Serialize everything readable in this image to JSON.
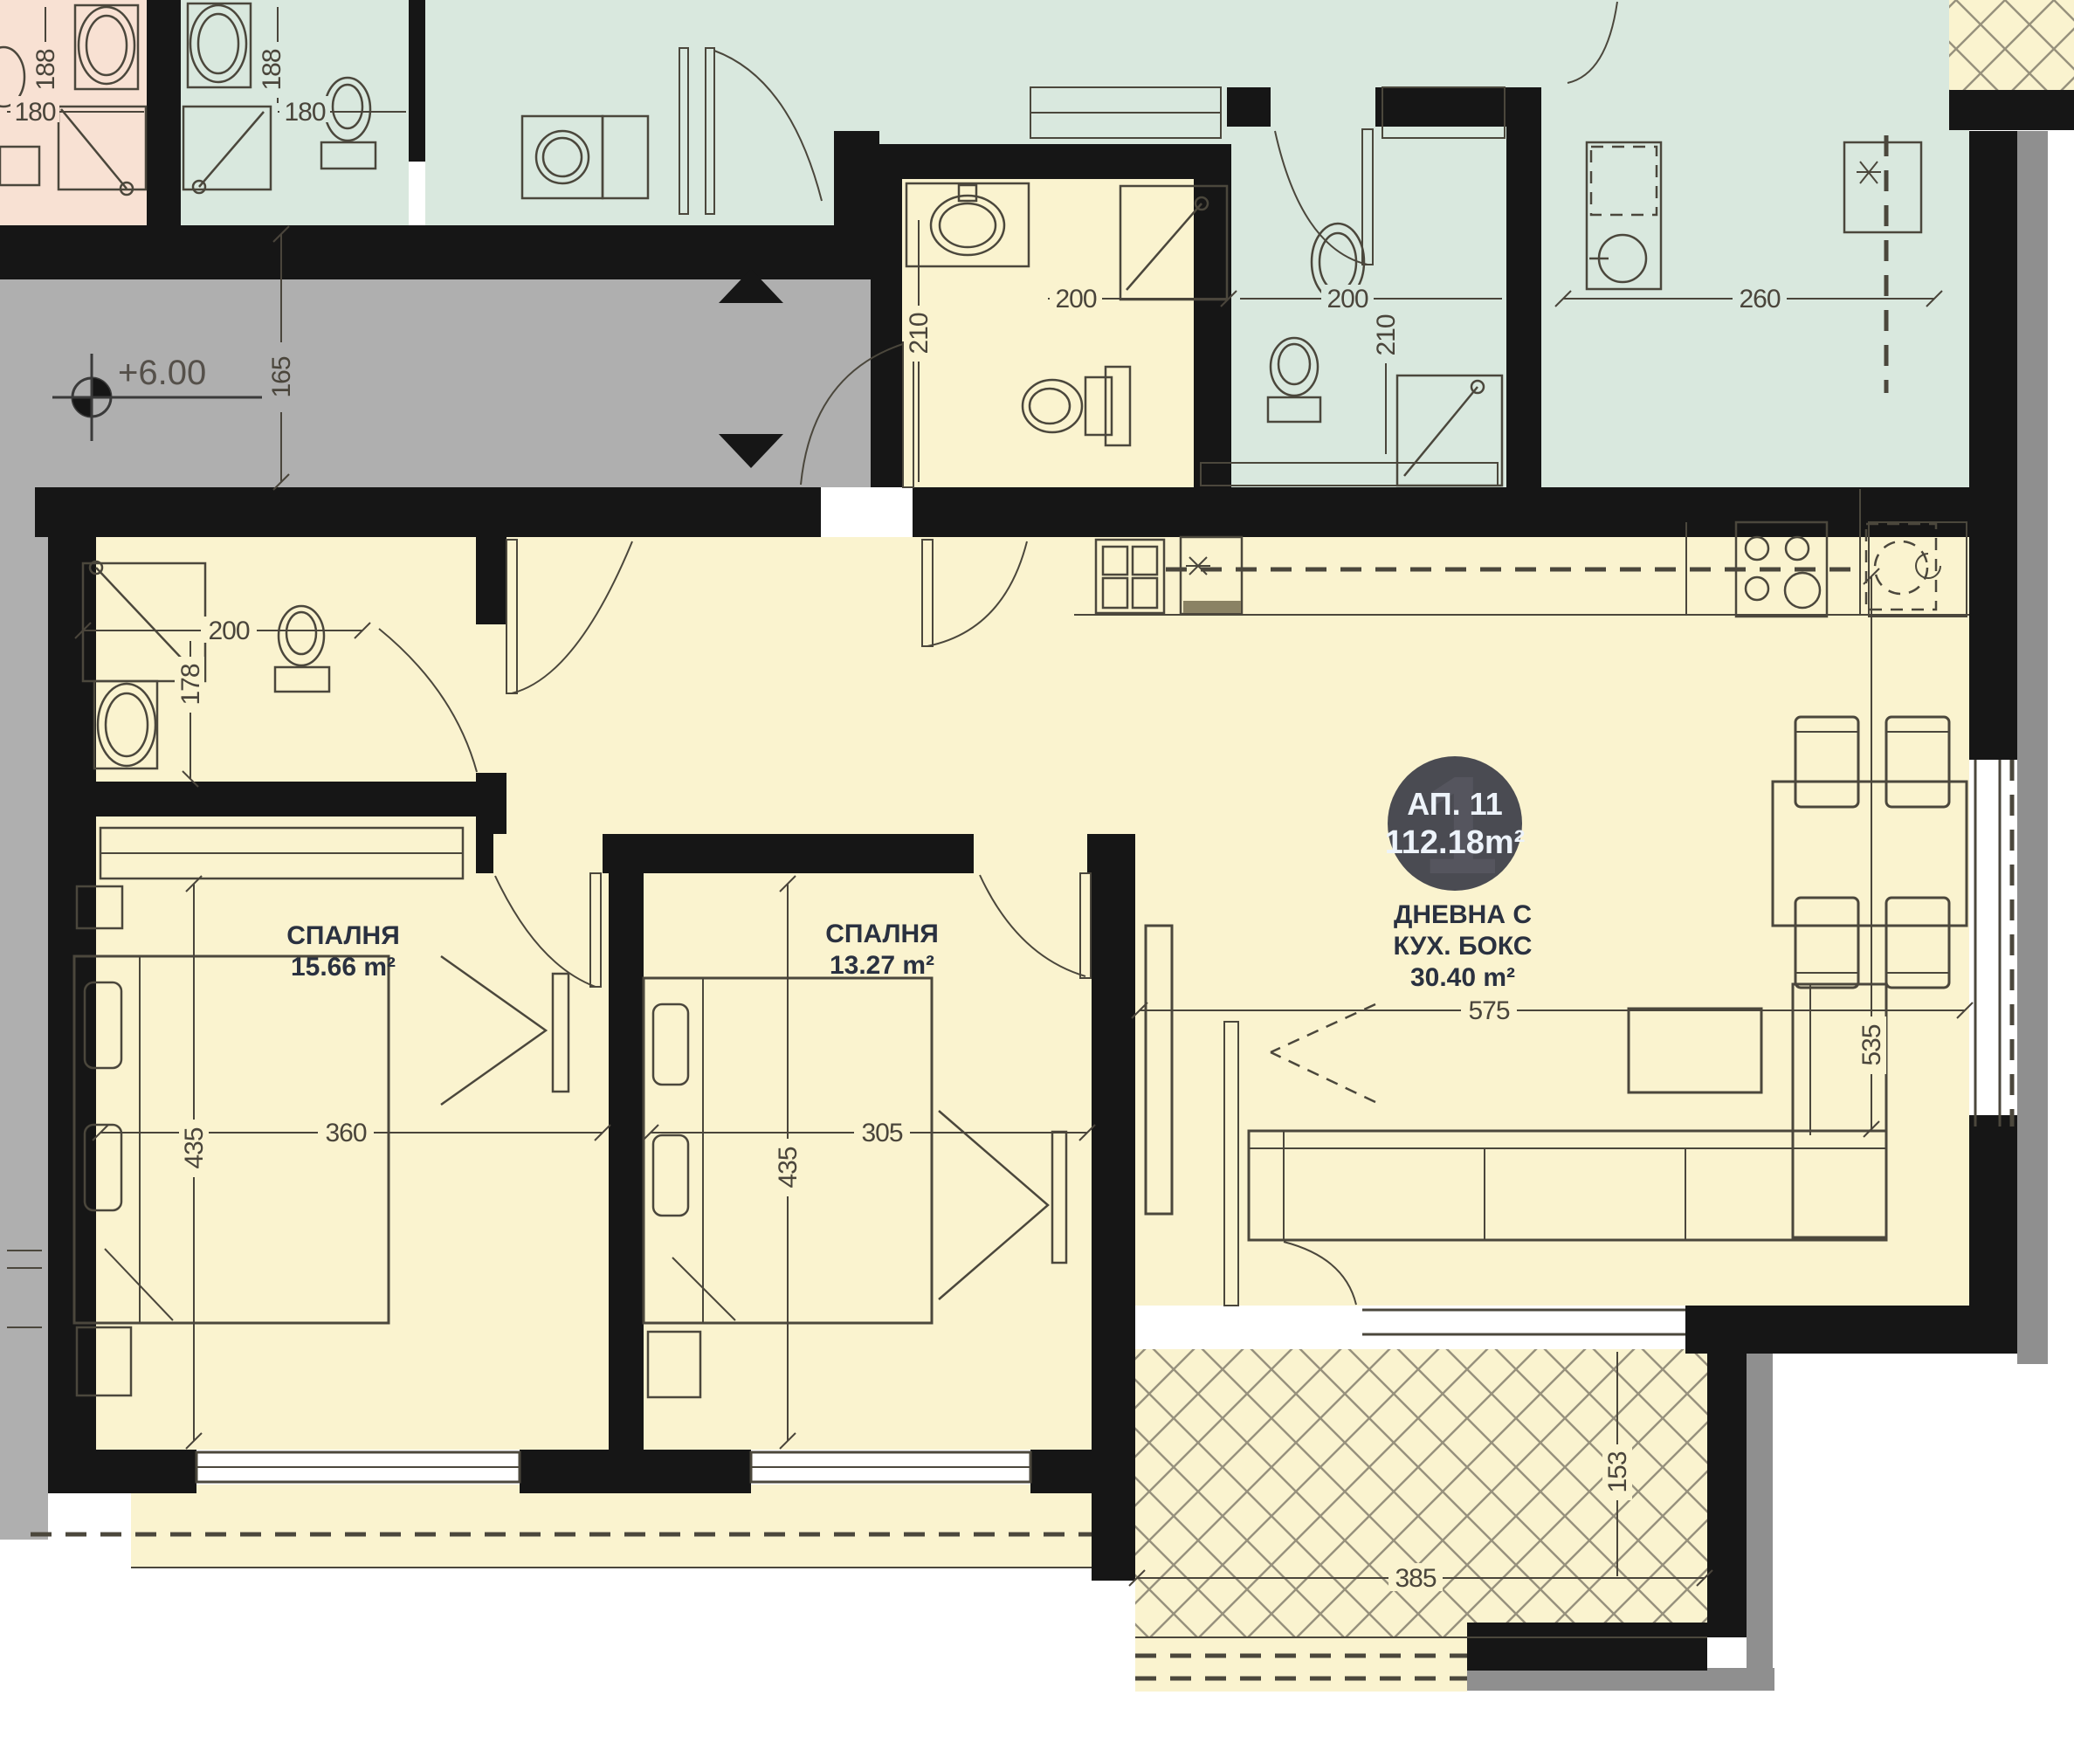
{
  "plan_title": "Apartment floor plan",
  "colors": {
    "wall": "#161616",
    "room_yellow": "#FAF3CF",
    "room_green": "#D9E8DE",
    "room_pink": "#F8E1D3",
    "corridor_gray": "#AFAFAF",
    "trim_gray": "#8F8F8F",
    "line": "#4B473C",
    "label_text": "#2A3140",
    "badge_bg": "#4A4B52",
    "badge_text": "#EDF3FA"
  },
  "badge": {
    "title": "АП. 11",
    "area": "112.18m²",
    "bg_digit": "1"
  },
  "rooms": {
    "bedroom1": {
      "name": "СПАЛНЯ",
      "area": "15.66 m²"
    },
    "bedroom2": {
      "name": "СПАЛНЯ",
      "area": "13.27 m²"
    },
    "living": {
      "name_line1": "ДНЕВНА С",
      "name_line2": "КУХ. БОКС",
      "area": "30.40 m²"
    }
  },
  "level_marker": {
    "value": "+6.00"
  },
  "dimensions": {
    "corridor_height": "165",
    "pink_shower_w": "180",
    "pink_shower_h": "188",
    "greenb_shower_w": "180",
    "greenb_shower_h": "188",
    "bath2_w": "200",
    "bath2_h": "178",
    "bath1_w": "200",
    "bath1_h": "210",
    "bathd_w": "200",
    "bathd_h": "210",
    "green_kitchen_w": "260",
    "bedroom1_w": "360",
    "bedroom1_h": "435",
    "bedroom2_w": "305",
    "bedroom2_h": "435",
    "living_w": "575",
    "living_h": "535",
    "balcony_w": "385",
    "balcony_h": "153"
  }
}
